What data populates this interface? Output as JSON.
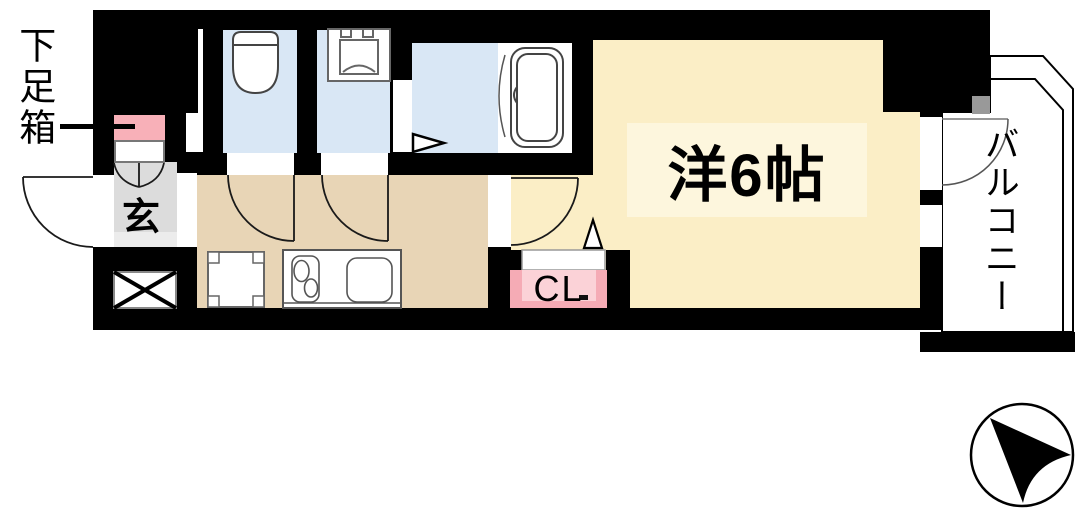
{
  "title": "apartment-floor-plan",
  "labels": {
    "shoe_box": "下足箱",
    "entrance": "玄",
    "main_room": "洋6帖",
    "closet": "CL",
    "balcony": "バルコニー"
  },
  "colors": {
    "wall": "#000000",
    "wet_room": "#d9e7f5",
    "main_room": "#fbeec6",
    "main_room_label_bg": "#fdf6dd",
    "kitchen_hall": "#e8d5b6",
    "entrance_gray": "#dcdcdc",
    "entrance_step": "#ececec",
    "shoe_box_pink": "#f8b0b8",
    "closet_pink": "#f5abb5",
    "closet_pink_light": "#fbd2d7",
    "door_panel_gray": "#999999",
    "line": "#1a1a1a"
  },
  "icons": {
    "compass": "north-arrow-in-circle",
    "toilet": "toilet-bowl-symbol",
    "washing_machine": "washing-machine-pan-symbol",
    "bathtub": "bathtub-symbol",
    "stove": "two-burner-stove-symbol",
    "sink": "kitchen-sink-symbol",
    "refrigerator_space": "corner-bracket-square",
    "pipe_shaft": "crossed-box",
    "closet_door": "folding-door-triangle",
    "bath_entry": "entry-direction-triangle",
    "door_swing": "quarter-circle-arc"
  }
}
